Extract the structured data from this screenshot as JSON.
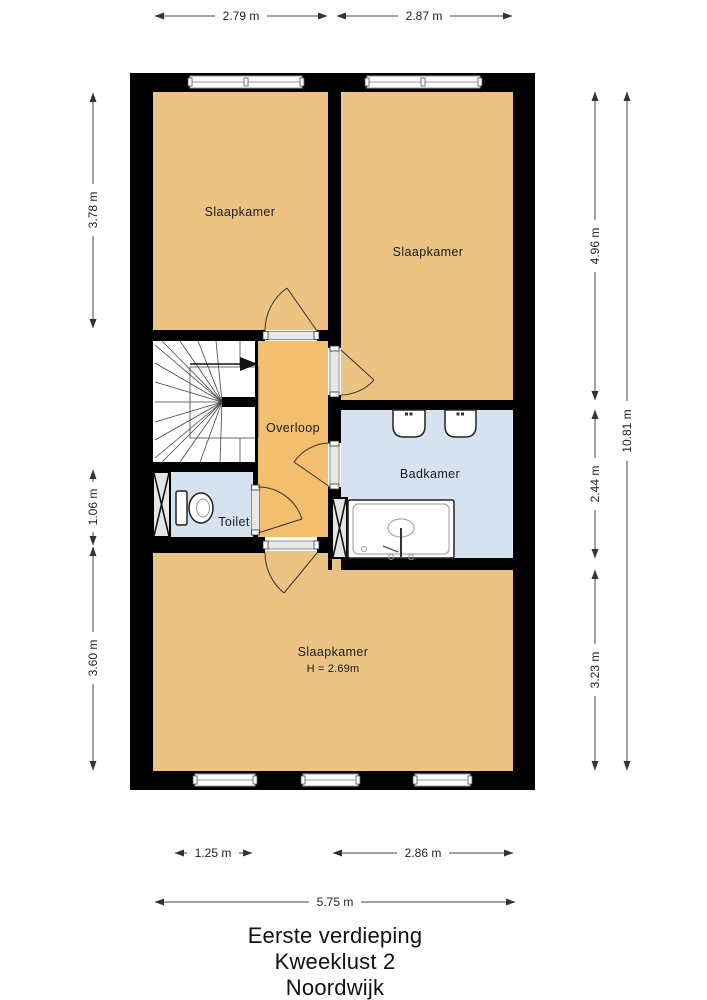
{
  "title": {
    "floor": "Eerste verdieping",
    "address": "Kweeklust 2",
    "city": "Noordwijk"
  },
  "rooms": {
    "bedroom_top_left": "Slaapkamer",
    "bedroom_top_right": "Slaapkamer",
    "landing": "Overloop",
    "toilet": "Toilet",
    "bathroom": "Badkamer",
    "bedroom_bottom": "Slaapkamer",
    "bedroom_bottom_ceiling_height": "H = 2.69m"
  },
  "dimensions": {
    "top": [
      "2.79 m",
      "2.87 m"
    ],
    "left": [
      "3.78 m",
      "1.06 m",
      "3.60 m"
    ],
    "right": [
      "4.96 m",
      "2.44 m",
      "3.23 m",
      "10.81 m"
    ],
    "bottom": [
      "1.25 m",
      "2.86 m",
      "5.75 m"
    ]
  },
  "colors": {
    "wall": "#000000",
    "bedroom_fill": "#ecc383",
    "landing_fill": "#f3bf6e",
    "wet_room_fill": "#d6e2ef",
    "stair_fill": "#ffffff",
    "dimension_line": "#444444"
  }
}
